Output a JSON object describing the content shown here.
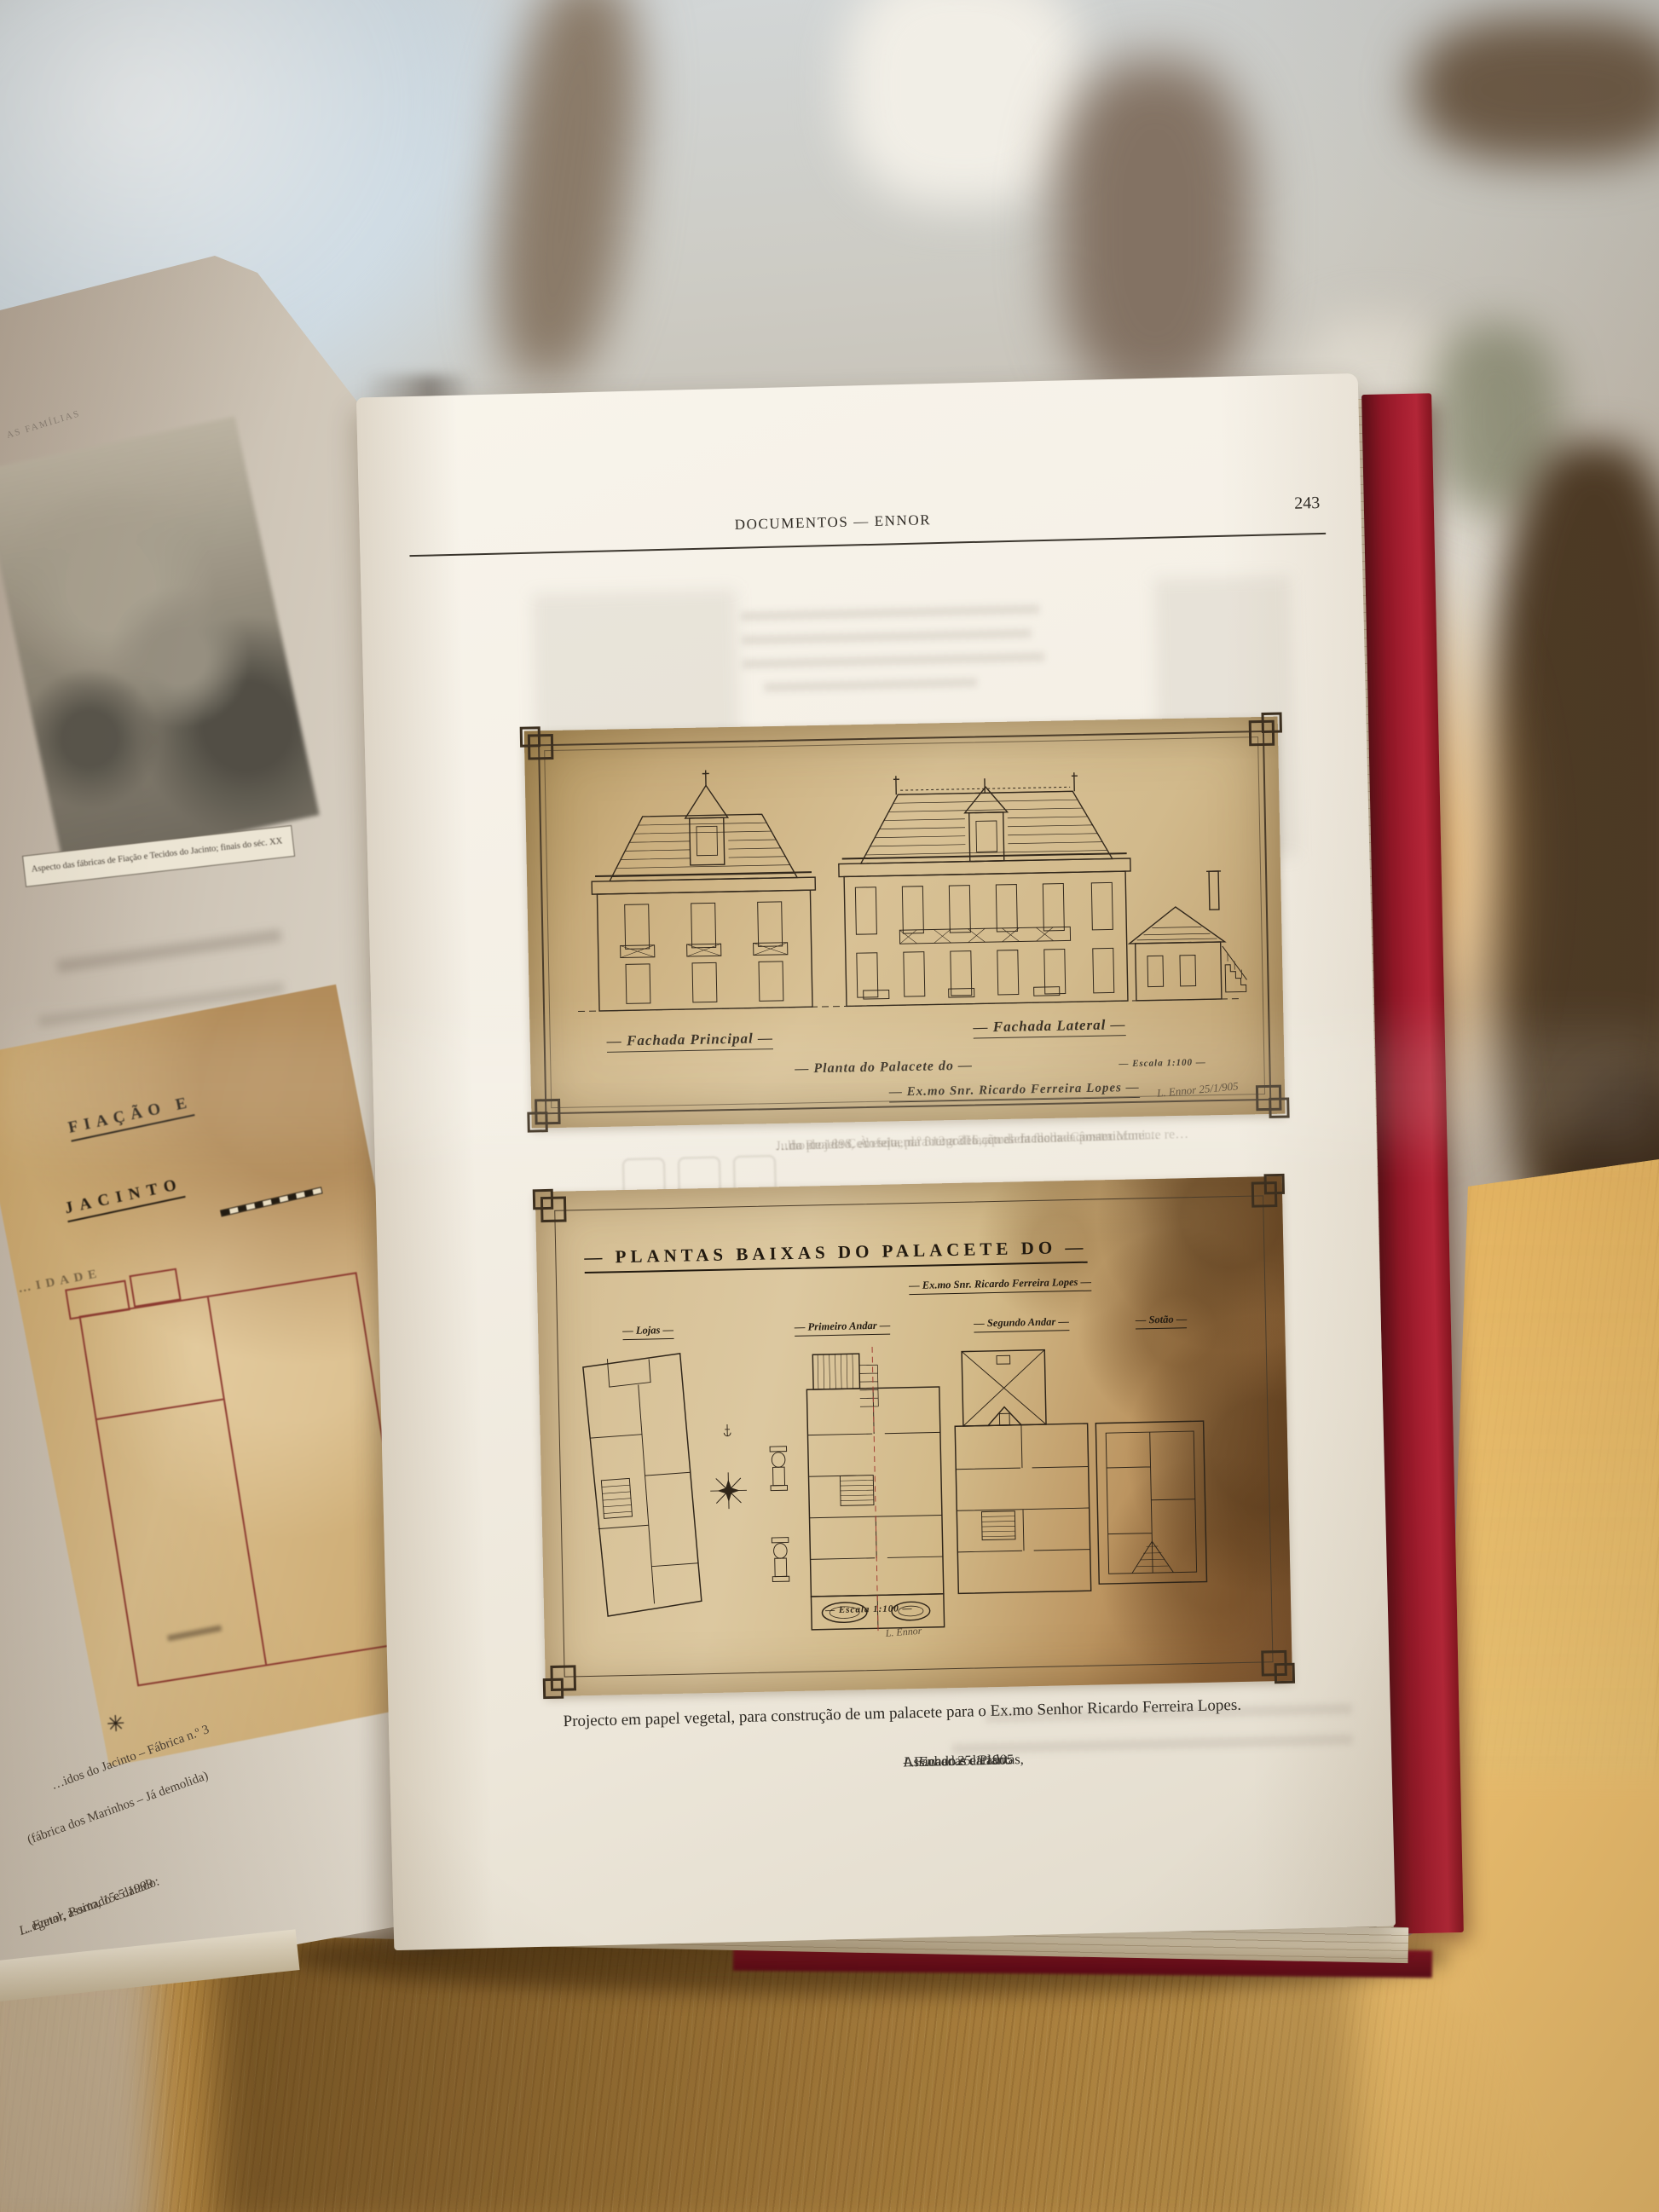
{
  "colors": {
    "cover_red": "#a01d2e",
    "page_cream": "#f4efe5",
    "parchment": "#d2ba8e",
    "table_wood": "#c9944a",
    "ink": "#32281c"
  },
  "right_page": {
    "header": {
      "title": "DOCUMENTOS — ENNOR",
      "page_number": "243"
    },
    "fig_elevations": {
      "label_left": "— Fachada Principal —",
      "label_right": "— Fachada Lateral —",
      "title": "— Planta do Palacete do —",
      "subtitle": "— Ex.mo Snr. Ricardo Ferreira Lopes —",
      "scale_note": "— Escala 1:100 —",
      "signature": "L. Ennor 25/1/905"
    },
    "fig_plans": {
      "title": "— PLANTAS BAIXAS DO PALACETE DO —",
      "subtitle": "— Ex.mo Snr. Ricardo Ferreira Lopes —",
      "labels": [
        "— Lojas —",
        "— Primeiro Andar —",
        "— Segundo Andar —",
        "— Sotão —"
      ],
      "scale_note": "— Escala 1:100 —",
      "signature": "L. Ennor"
    },
    "ghost_lines": [
      "…do projecto, em tela, para remodelação da fachada e constru…",
      "…na Rua de Cedofeita, n.º 312 a 316, apresentado na Câmara Muni…",
      "Julho de 1898. À esquerda fotografia actual da fachada posteriormente re…"
    ],
    "caption": {
      "line1": "Projecto em papel vegetal, para construção de um palacete para o Ex.mo Senhor Ricardo Ferreira Lopes.",
      "line2_prefix": "Assinado e datado: ",
      "line2_em": "L. Ennor 25.1.1905",
      "line2_suffix": " – Fachadas e Plantas,"
    }
  },
  "left_page": {
    "running_header": "AS FAMÍLIAS",
    "photo_caption": "Aspecto das fábricas de Fiação e Tecidos do Jacinto; finais do séc. XX",
    "plan_heading_line1": "FIAÇÃO E",
    "plan_heading_line2": "JACINTO",
    "plan_heading_line3": "…IDADE",
    "compass_icon": "✳",
    "rot_caption_line1": "…idos do Jacinto – Fábrica n.º 3",
    "rot_caption_line2": "(fábrica dos Marinhos – Já demolida)",
    "rot_caption_line3_prefix": "…egetal, assinado e datado: ",
    "rot_caption_line3_em": "L. Ennor, Porto, 15.5.1999"
  }
}
